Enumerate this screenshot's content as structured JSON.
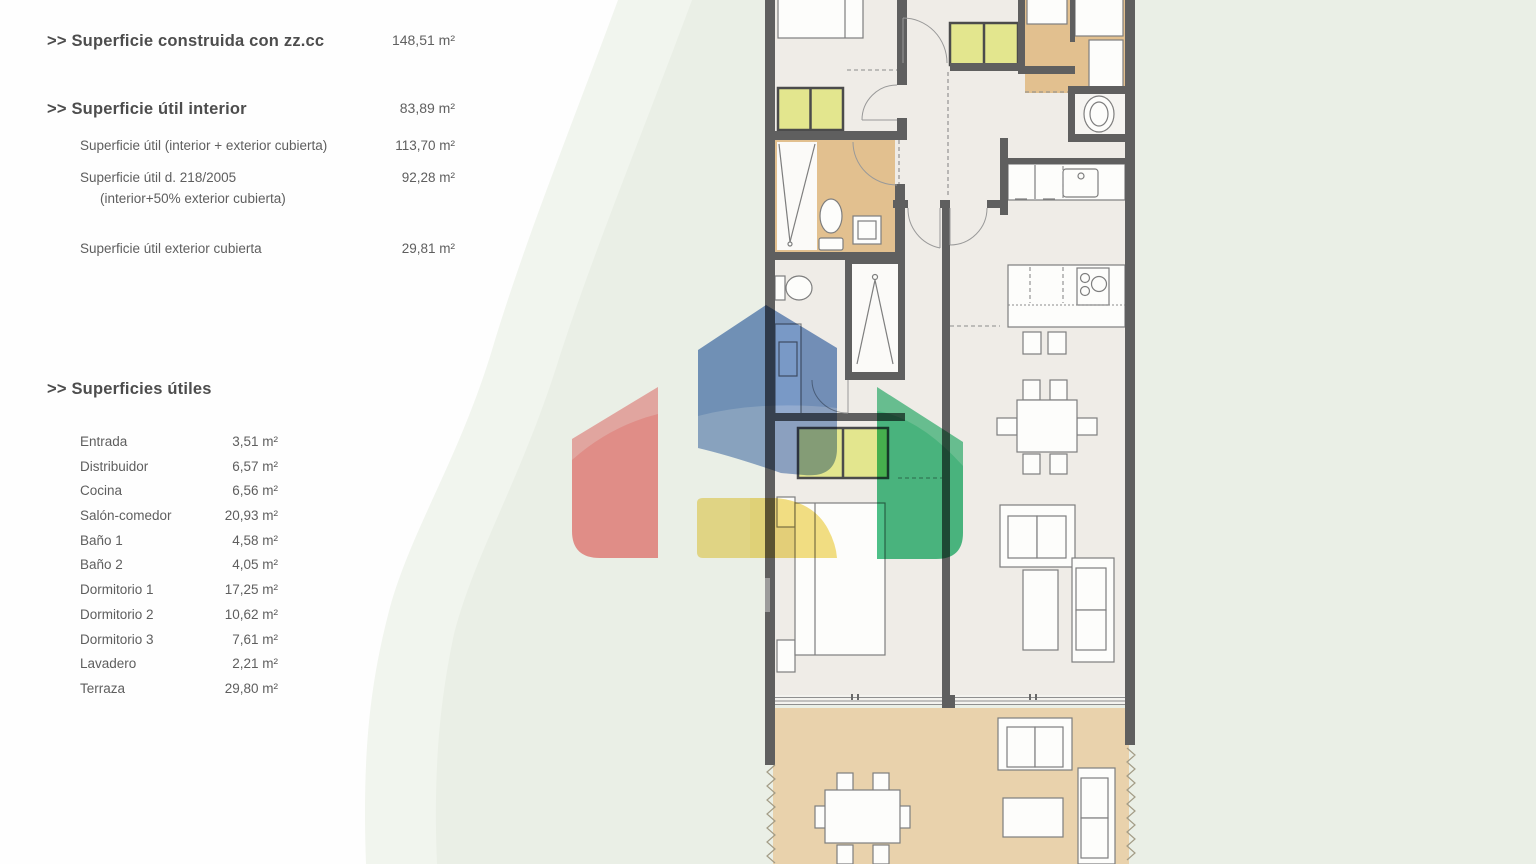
{
  "panel": {
    "construida": {
      "title": ">> Superficie construida con zz.cc",
      "value": "148,51 m²"
    },
    "util_interior": {
      "title": ">> Superficie útil interior",
      "value": "83,89 m²"
    },
    "util_rows": [
      {
        "label": "Superficie útil (interior + exterior cubierta)",
        "label2": "",
        "value": "113,70 m²"
      },
      {
        "label": "Superficie útil  d. 218/2005",
        "label2": "(interior+50% exterior cubierta)",
        "value": "92,28 m²"
      },
      {
        "label": "Superficie útil exterior cubierta",
        "label2": "",
        "value": "29,81 m²"
      }
    ],
    "utiles": {
      "title": ">> Superficies útiles",
      "rooms": [
        [
          "Entrada",
          "3,51 m²"
        ],
        [
          "Distribuidor",
          "6,57 m²"
        ],
        [
          "Cocina",
          "6,56 m²"
        ],
        [
          "Salón-comedor",
          "20,93 m²"
        ],
        [
          "Baño 1",
          "4,58 m²"
        ],
        [
          "Baño 2",
          "4,05 m²"
        ],
        [
          "Dormitorio 1",
          "17,25 m²"
        ],
        [
          "Dormitorio 2",
          "10,62 m²"
        ],
        [
          "Dormitorio 3",
          "7,61 m²"
        ],
        [
          "Lavadero",
          "2,21 m²"
        ],
        [
          "Terraza",
          "29,80 m²"
        ]
      ]
    }
  },
  "background": {
    "blob_outer": "#f1f5ee",
    "blob_inner": "#eaefe6"
  },
  "floorplan": {
    "wall_color": "#5f5f5f",
    "floor_color": "#efece7",
    "wet_floor_color": "#e2c08f",
    "terrace_floor_color": "#e9d2ac",
    "wardrobe_color": "#e3e68e",
    "furniture_line_color": "#7e7e7e"
  },
  "watermark": {
    "blue": "#6288c0",
    "red": "#f28383",
    "green": "#2fb875",
    "yellow": "#f1da6e"
  }
}
